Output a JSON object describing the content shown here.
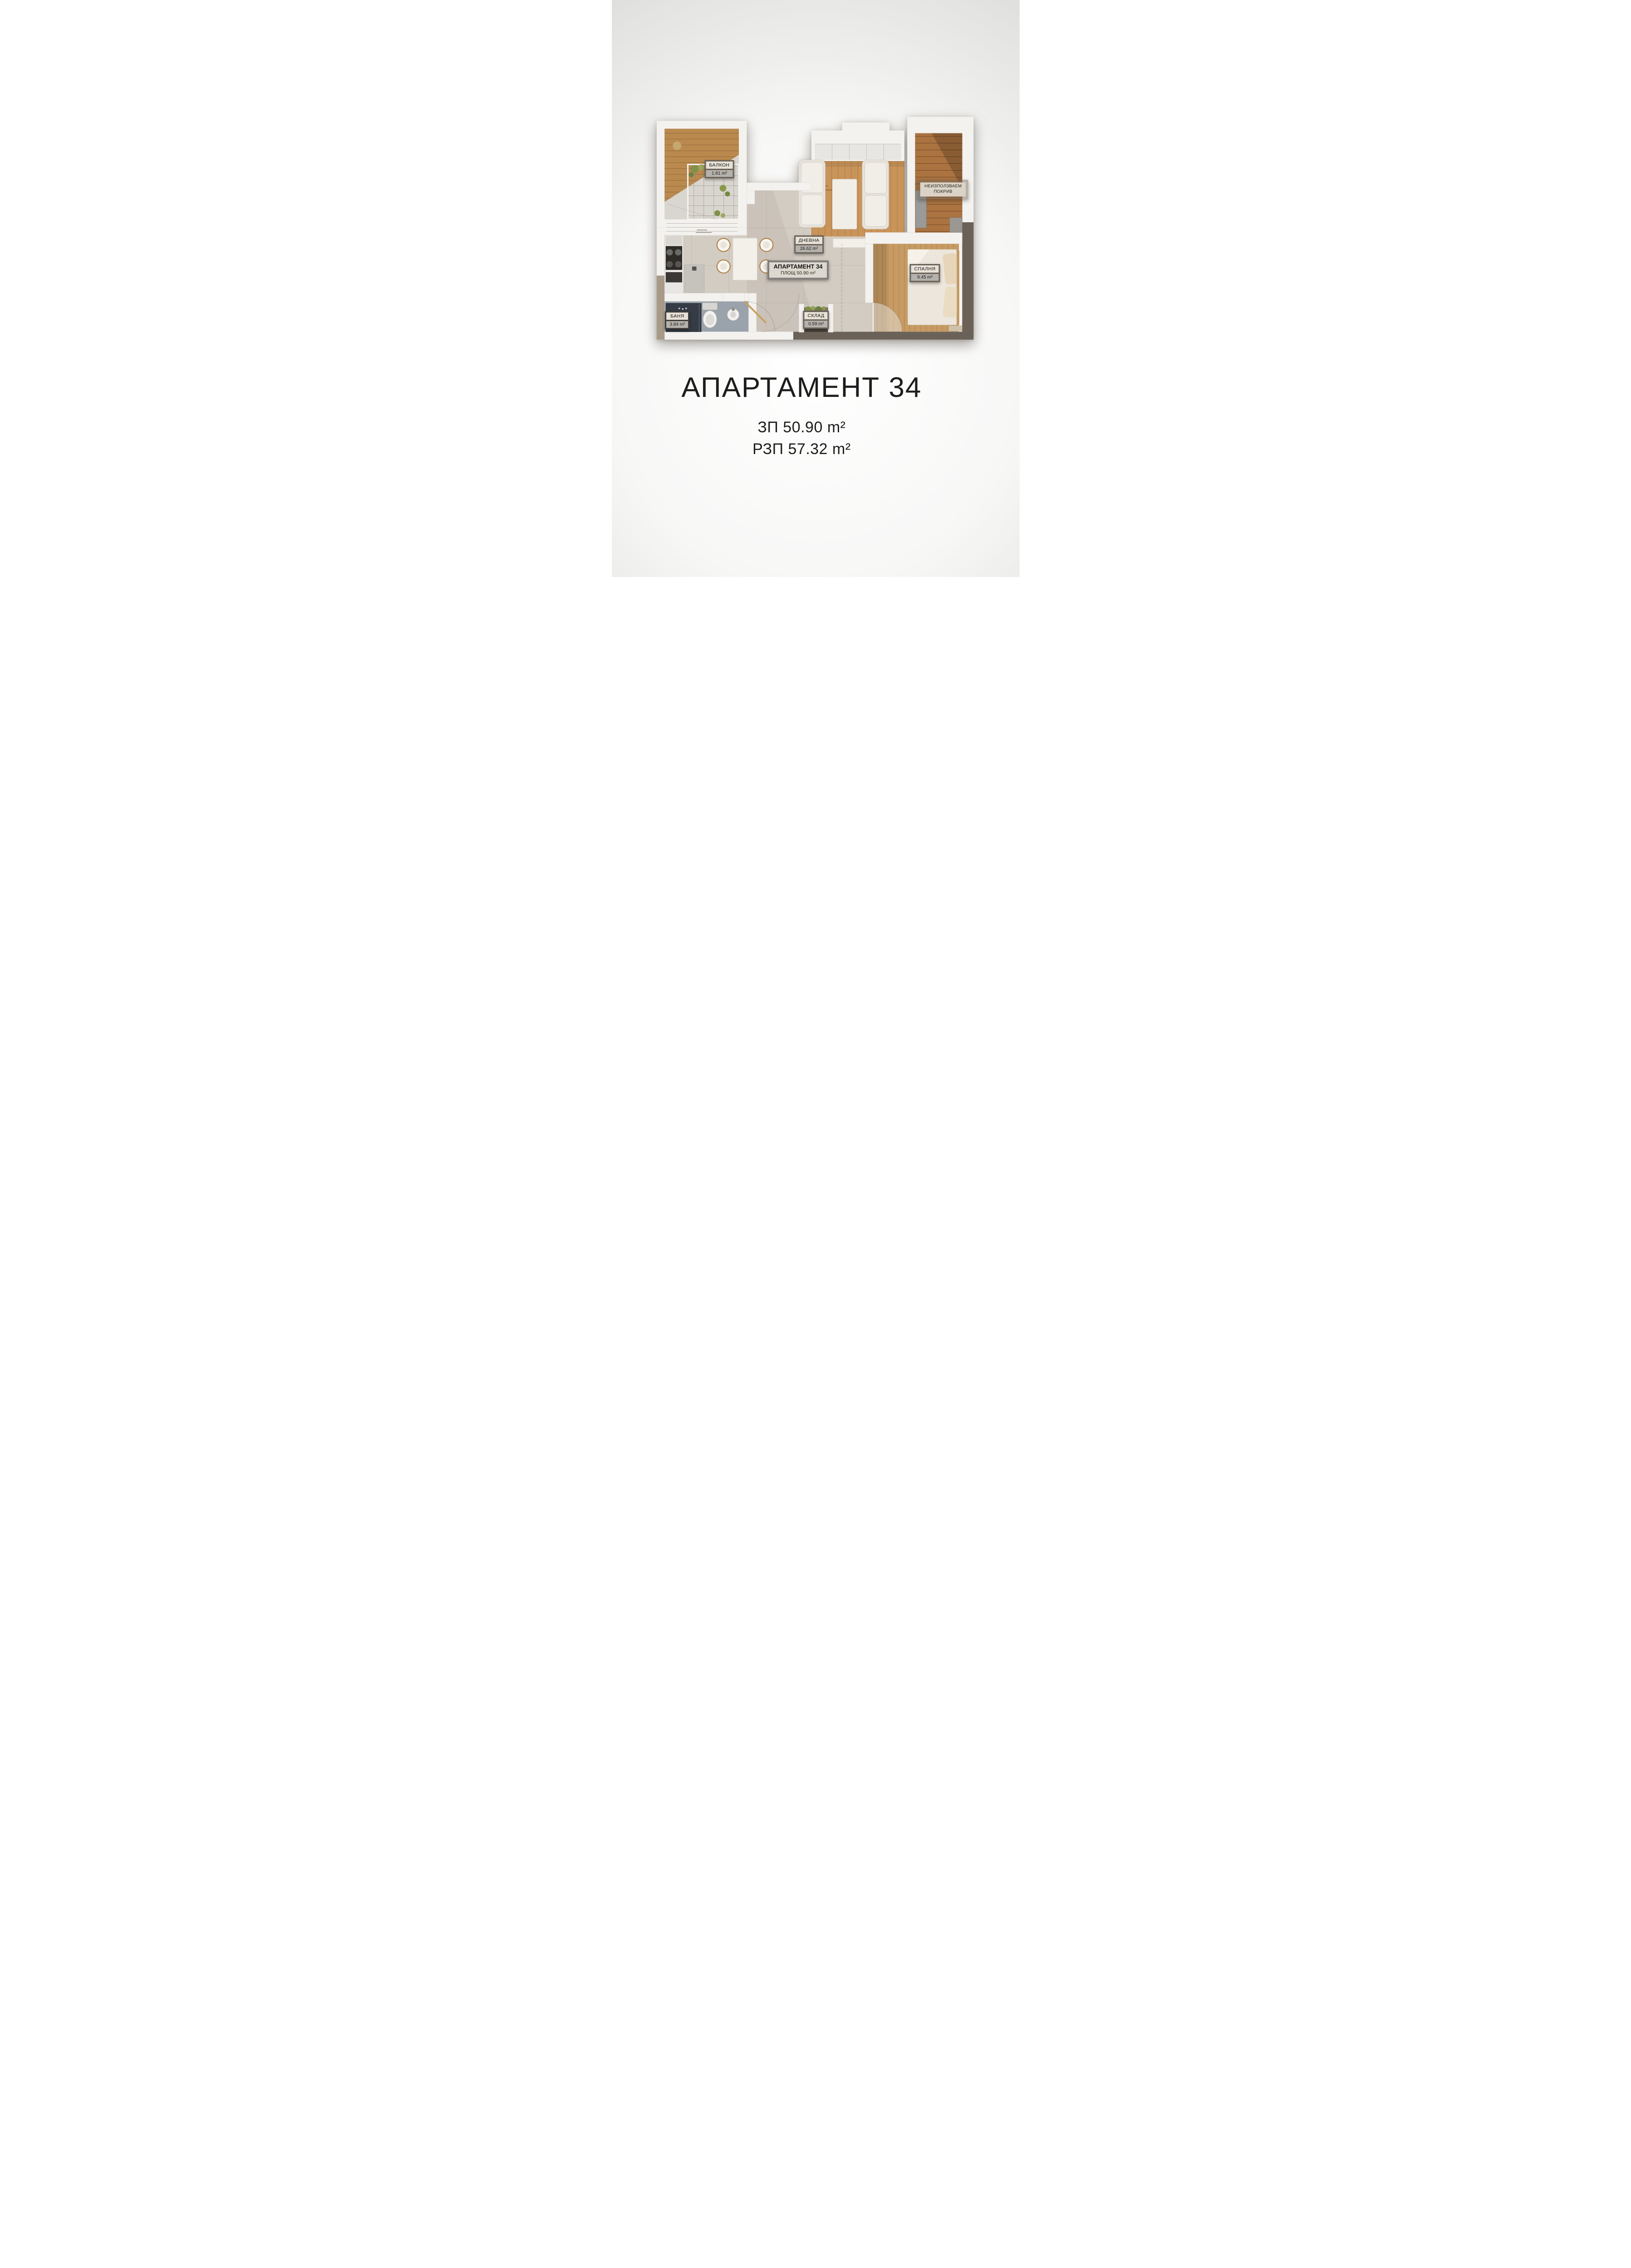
{
  "floor_plan": {
    "labels": {
      "balcony": {
        "name": "БАЛКОН",
        "area": "1.81 m²"
      },
      "unused_roof": {
        "line1": "НЕИЗПОЛЗВАЕМ",
        "line2": "ПОКРИВ"
      },
      "living_room": {
        "name": "ДНЕВНА",
        "area": "26.62 m²"
      },
      "apartment": {
        "name": "АПАРТАМЕНТ 34",
        "area": "ПЛОЩ 50.90 m²"
      },
      "bedroom": {
        "name": "СПАЛНЯ",
        "area": "9.45 m²"
      },
      "bathroom": {
        "name": "БАНЯ",
        "area": "3.84 m²"
      },
      "storage": {
        "name": "СКЛАД",
        "area": "0.59 m²"
      }
    },
    "colors": {
      "wall_white": "#f4f2ef",
      "accent_taupe_dark": "#6b6156",
      "accent_taupe_light": "#a89a88",
      "screed_floor": "#d3ccc3",
      "living_wood": "#c9945a",
      "roof_wood": "#aa7340",
      "bedroom_wood": "#c79b63",
      "balcony_wood": "#b9894e",
      "bathroom_floor": "#9aa2ab",
      "shower_dark": "#353c46",
      "label_frame": "#6b6357",
      "label_name_bg": "#e7e1d8",
      "label_area_bg": "#b5b1ac"
    }
  },
  "footer": {
    "title": "АПАРТАМЕНТ 34",
    "zp": "ЗП 50.90 m²",
    "rzp": "РЗП 57.32 m²"
  }
}
